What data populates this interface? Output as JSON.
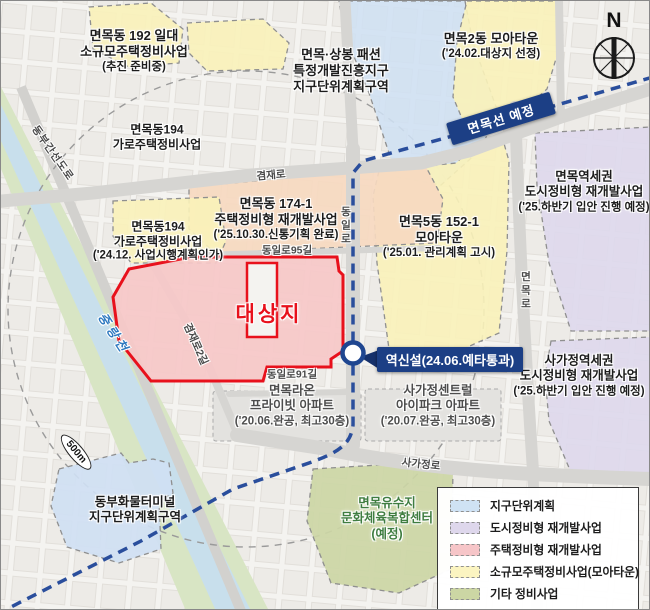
{
  "labels": {
    "area_192": [
      "면목동 192 일대",
      "소규모주택정비사업",
      "(추진 준비중)"
    ],
    "area_194_top": [
      "면목동194",
      "가로주택정비사업"
    ],
    "area_194": [
      "면목동194",
      "가로주택정비사업",
      "('24.12. 사업시행계획인가)"
    ],
    "fashion": [
      "면목·상봉 패션",
      "특정개발진흥지구",
      "지구단위계획구역"
    ],
    "moa_2dong": [
      "면목2동 모아타운",
      "('24.02.대상지 선정)"
    ],
    "area_174": [
      "면목동 174-1",
      "주택정비형 재개발사업",
      "('25.10.30.신통기획 완료)"
    ],
    "moa_152": [
      "면목5동 152-1",
      "모아타운",
      "('25.01. 관리계획 고시)"
    ],
    "myeonmok_station": [
      "면목역세권",
      "도시정비형 재개발사업",
      "('25.하반기 입안 진행 예정)"
    ],
    "sagajeong_station": [
      "사가정역세권",
      "도시정비형 재개발사업",
      "('25.하반기 입안 진행 예정)"
    ],
    "raon_apt": [
      "면목라온",
      "프라이빗 아파트",
      "('20.06.완공, 최고30층)"
    ],
    "ipark_apt": [
      "사가정센트럴",
      "아이파크 아파트",
      "('20.07.완공, 최고30층)"
    ],
    "yusuji": [
      "면목유수지",
      "문화체육복합센터",
      "(예정)"
    ],
    "terminal": [
      "동부화물터미널",
      "지구단위계획구역"
    ],
    "target_site": "대상지",
    "new_station_banner": "역신설(24.06.예타통과)",
    "line_banner": "면목선 예정",
    "ring_distance": "500m",
    "compass": "N"
  },
  "streets": {
    "gyeomjae": "겸재로",
    "gyeomjae2": "겸재로2길",
    "dongil95": "동일로95길",
    "dongil91": "동일로91길",
    "dongil": "동일로",
    "myeonmok_ro": "면목로",
    "sagajeong_ro": "사가정로",
    "dongbu_expwy": "동부간선도로",
    "jungnang_stream": "중랑천"
  },
  "legend": {
    "items": [
      {
        "label": "지구단위계획",
        "color": "#cfe2f4"
      },
      {
        "label": "도시정비형 재개발사업",
        "color": "#ded7ec"
      },
      {
        "label": "주택정비형 재개발사업",
        "color": "#f6c5c8"
      },
      {
        "label": "소규모주택정비사업(모아타운)",
        "color": "#fbf4c1"
      },
      {
        "label": "기타 정비사업",
        "color": "#ccd6a4"
      },
      {
        "label": "완료 정비사업",
        "color": "#c6c6c6"
      }
    ]
  },
  "colors": {
    "rail_line": "#2a4e9c",
    "banner_navy": "#1c3f85",
    "target_border": "#e8111c",
    "target_fill": "#f6c8c8",
    "zone_blue": "#cfe0f3",
    "zone_purple": "#ded8ec",
    "zone_yellow": "#f9f2b9",
    "zone_peach": "#f6d9c0",
    "zone_olive": "#ccd6a5",
    "stream_green": "#d8e5c4",
    "stream_water": "#c8dfec"
  }
}
